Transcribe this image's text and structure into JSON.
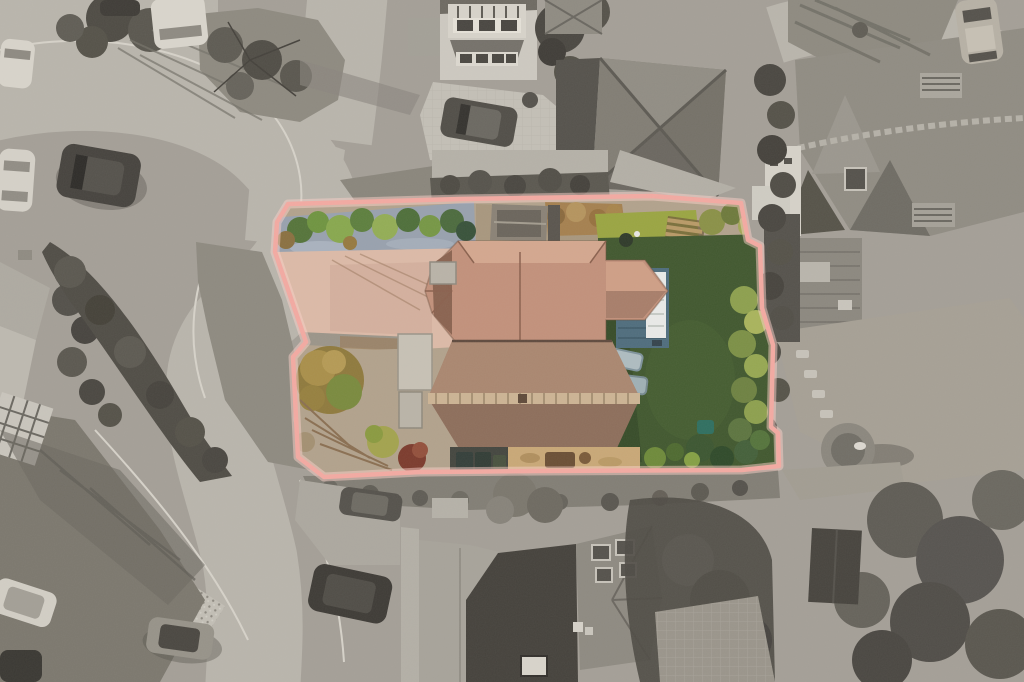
{
  "meta": {
    "title": "Top-down aerial drone photograph of a detached property",
    "image_type": "estate-agent aerial photo",
    "effect": "surroundings desaturated to grayscale, plot in colour inside a pink boundary overlay"
  },
  "canvas": {
    "width": 1024,
    "height": 682
  },
  "boundary": {
    "points": "288,204 460,199 652,196 741,203 748,240 760,246 762,308 773,345 771,427 778,433 779,466 742,470 540,471 420,472 324,477 298,457 293,357 306,342 275,252 277,222",
    "stroke_width": 4.5,
    "glow_width": 9,
    "color": "#f3aaa2",
    "glow_color": "#f9cfc8"
  },
  "colors": {
    "ground": "#a49f97",
    "road": "#b9b5ac",
    "paving": "#c3bfb6",
    "kerb": "#d6d2c9",
    "verge": "#8e8a80",
    "vergeDark": "#7c786e",
    "hedgeGray": "#504d46",
    "treeGray": "#4e4b44",
    "treeMid": "#6b6861",
    "shadowGray": "#5f5c55",
    "wallLight": "#cdc9c0",
    "roofGrayLight": "#a9a59c",
    "roofGray": "#817d74",
    "roofGrayDark": "#5d5a53",
    "carWhite": "#d8d4cb",
    "carDark": "#46433e",
    "driveway": "#dcbaa7",
    "drivewayShade": "#d0ad9a",
    "slate": "#98a1ae",
    "bushGreen": "#6f9440",
    "bushLime": "#93ad55",
    "conifer": "#4c6b3e",
    "lawn": "#9aa542",
    "lawnDark": "#41582f",
    "hedgeOlive": "#8da04e",
    "autumn": "#a5804f",
    "mulch": "#b2a28c",
    "deck": "#4f6d7d",
    "sofa": "#e9eae8",
    "tileMain": "#c2917b",
    "tileLight": "#d4a78f",
    "tileDark": "#a87e6a",
    "tileFront": "#9b7863",
    "tileFrontDark": "#8d6e5b",
    "coping": "#ccb494",
    "shed": "#8a8276",
    "wood": "#b99a67",
    "sand": "#c9a877",
    "bin": "#323d36",
    "shrubRed": "#7c3b2d",
    "teal": "#2f6f60"
  },
  "regions": {
    "plot": {
      "label": "highlighted property plot",
      "features": [
        "terracotta hipped roofs",
        "block-paved driveway",
        "slate shrub bed",
        "garden shed",
        "rear lawn",
        "deck with white corner sofa",
        "sun loungers",
        "perimeter hedge",
        "wheelie bins",
        "autumn shrub bed"
      ]
    },
    "surroundings": {
      "label": "grayscale neighbourhood",
      "features": [
        "cul-de-sac junction",
        "parked cars",
        "neighbouring houses",
        "mature trees and shadows",
        "rear gardens",
        "round garden table",
        "shed"
      ]
    }
  }
}
